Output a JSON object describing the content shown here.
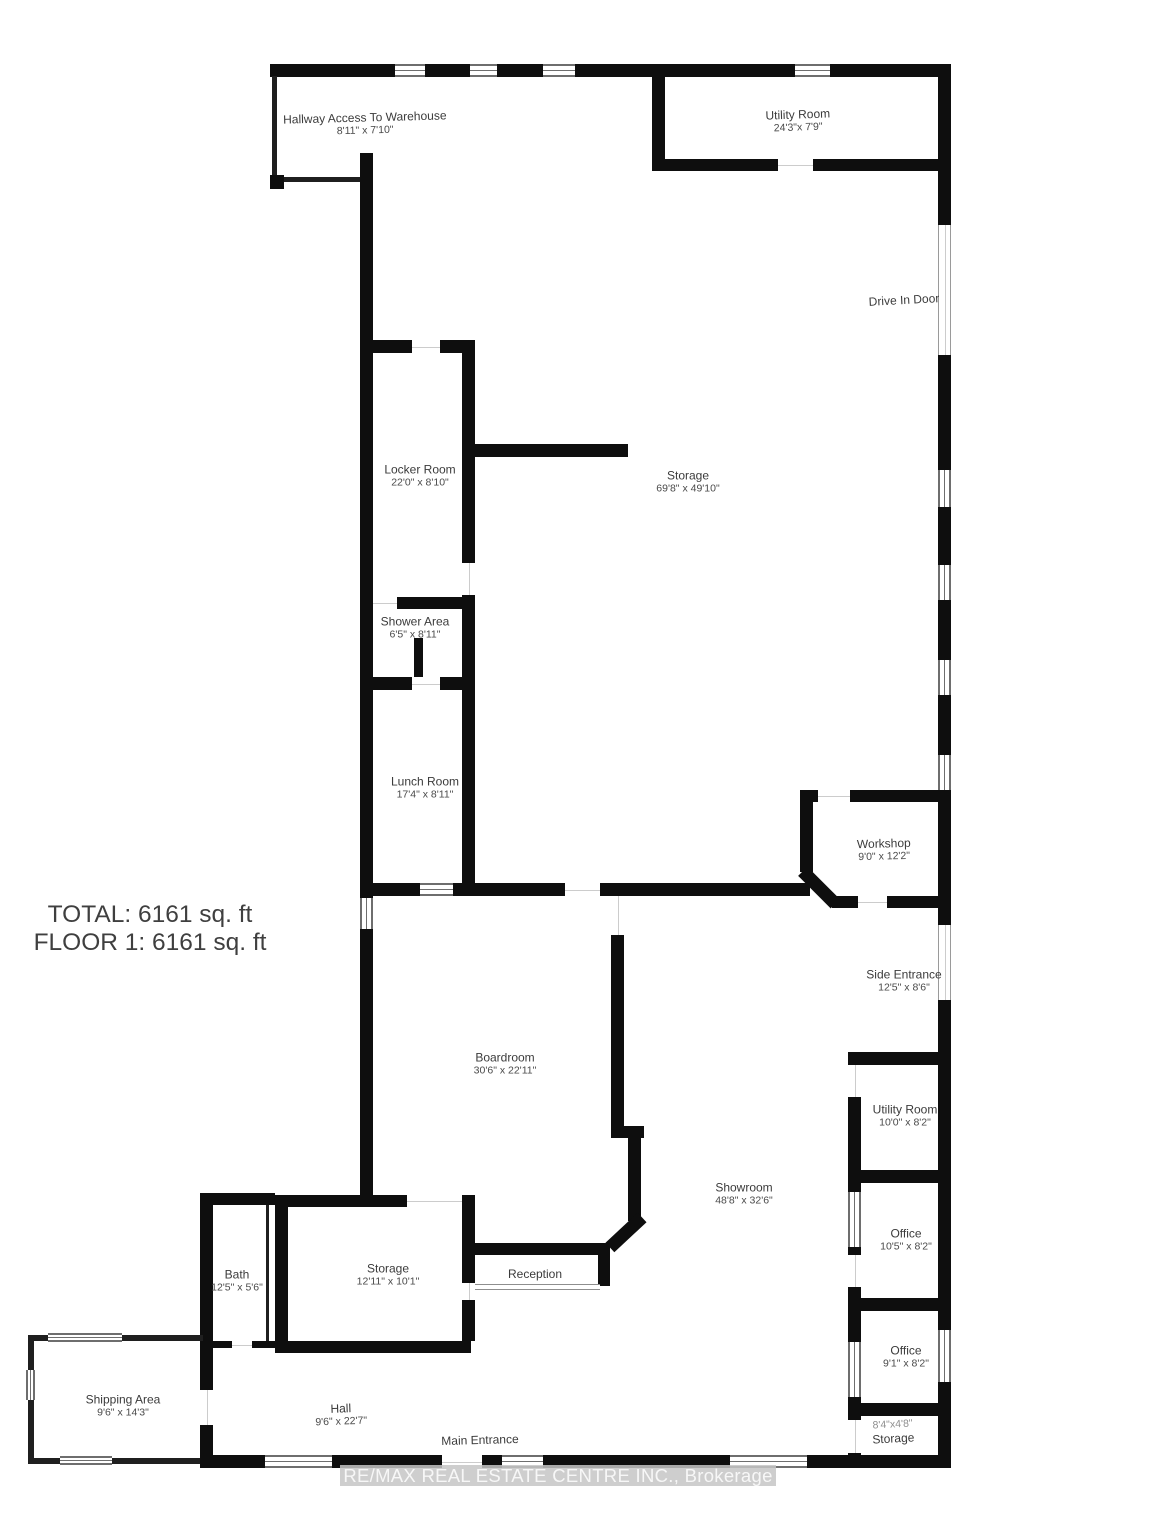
{
  "summary": {
    "total": "TOTAL: 6161 sq. ft",
    "floor1": "FLOOR 1: 6161 sq. ft"
  },
  "watermark": {
    "text": "RE/MAX REAL ESTATE CENTRE INC., Brokerage"
  },
  "rooms": [
    {
      "name": "Hallway Access To Warehouse",
      "dims": "8'11\" x 7'10\""
    },
    {
      "name": "Utility Room",
      "dims": "24'3\"x 7'9\""
    },
    {
      "name": "Drive In Door",
      "dims": ""
    },
    {
      "name": "Locker Room",
      "dims": "22'0\" x 8'10\""
    },
    {
      "name": "Storage",
      "dims": "69'8\" x 49'10\""
    },
    {
      "name": "Shower Area",
      "dims": "6'5\" x 8'11\""
    },
    {
      "name": "Lunch Room",
      "dims": "17'4\" x 8'11\""
    },
    {
      "name": "Workshop",
      "dims": "9'0\" x 12'2\""
    },
    {
      "name": "Side Entrance",
      "dims": "12'5\" x 8'6\""
    },
    {
      "name": "Boardroom",
      "dims": "30'6\" x 22'11\""
    },
    {
      "name": "Utility Room",
      "dims": "10'0\" x 8'2\""
    },
    {
      "name": "Showroom",
      "dims": "48'8\" x 32'6\""
    },
    {
      "name": "Office",
      "dims": "10'5\" x 8'2\""
    },
    {
      "name": "Office",
      "dims": "9'1\" x 8'2\""
    },
    {
      "name": "Bath",
      "dims": "12'5\" x 5'6\""
    },
    {
      "name": "Storage",
      "dims": "12'11\" x 10'1\""
    },
    {
      "name": "Reception",
      "dims": ""
    },
    {
      "name": "Shipping Area",
      "dims": "9'6\" x 14'3\""
    },
    {
      "name": "Hall",
      "dims": "9'6\" x 22'7\""
    },
    {
      "name": "Main Entrance",
      "dims": ""
    },
    {
      "name": "Storage",
      "dims": "8'4\"x4'8\""
    }
  ],
  "colors": {
    "wall": "#0e0e0e",
    "room_name_text": "#3b3b3b",
    "dims_text": "#4a4a4a",
    "muted_dims_text": "#8f8f8f",
    "window_frame": "#6e6e6e",
    "watermark_bg": "#c6c6c6",
    "watermark_text": "#f7f7f7"
  }
}
